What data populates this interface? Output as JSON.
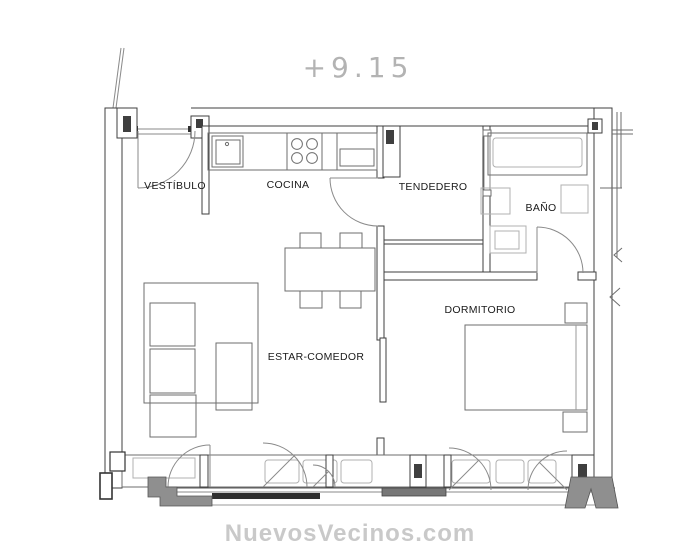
{
  "page": {
    "background": "#ffffff"
  },
  "plan": {
    "elevation_label": "+9.15",
    "rooms": [
      {
        "id": "vestibulo",
        "label": "VESTÍBULO"
      },
      {
        "id": "cocina",
        "label": "COCINA"
      },
      {
        "id": "tendedero",
        "label": "TENDEDERO"
      },
      {
        "id": "bano",
        "label": "BAÑO"
      },
      {
        "id": "dormitorio",
        "label": "DORMITORIO"
      },
      {
        "id": "estar-comedor",
        "label": "ESTAR-COMEDOR"
      }
    ],
    "furniture_icons": [
      "sofa-icon",
      "ottoman-icon",
      "chaise-icon",
      "dining-table-icon",
      "dining-chair-icon",
      "kitchen-sink-icon",
      "stove-icon",
      "fridge-icon",
      "bathtub-icon",
      "toilet-icon",
      "washbasin-icon",
      "bed-icon",
      "nightstand-icon",
      "door-swing-icon",
      "sliding-door-icon"
    ],
    "colors": {
      "wall": "#3f3f3f",
      "furniture": "#6e6e6e",
      "fixture": "#b0b0b0",
      "door_arc": "#8a8a8a",
      "gray_fill": "#8f8f8f",
      "label_text": "#1a1a1a",
      "elevation_text": "#b3b3b3",
      "watermark_text": "#c9c9c9"
    }
  },
  "watermark": {
    "text": "NuevosVecinos.com"
  }
}
